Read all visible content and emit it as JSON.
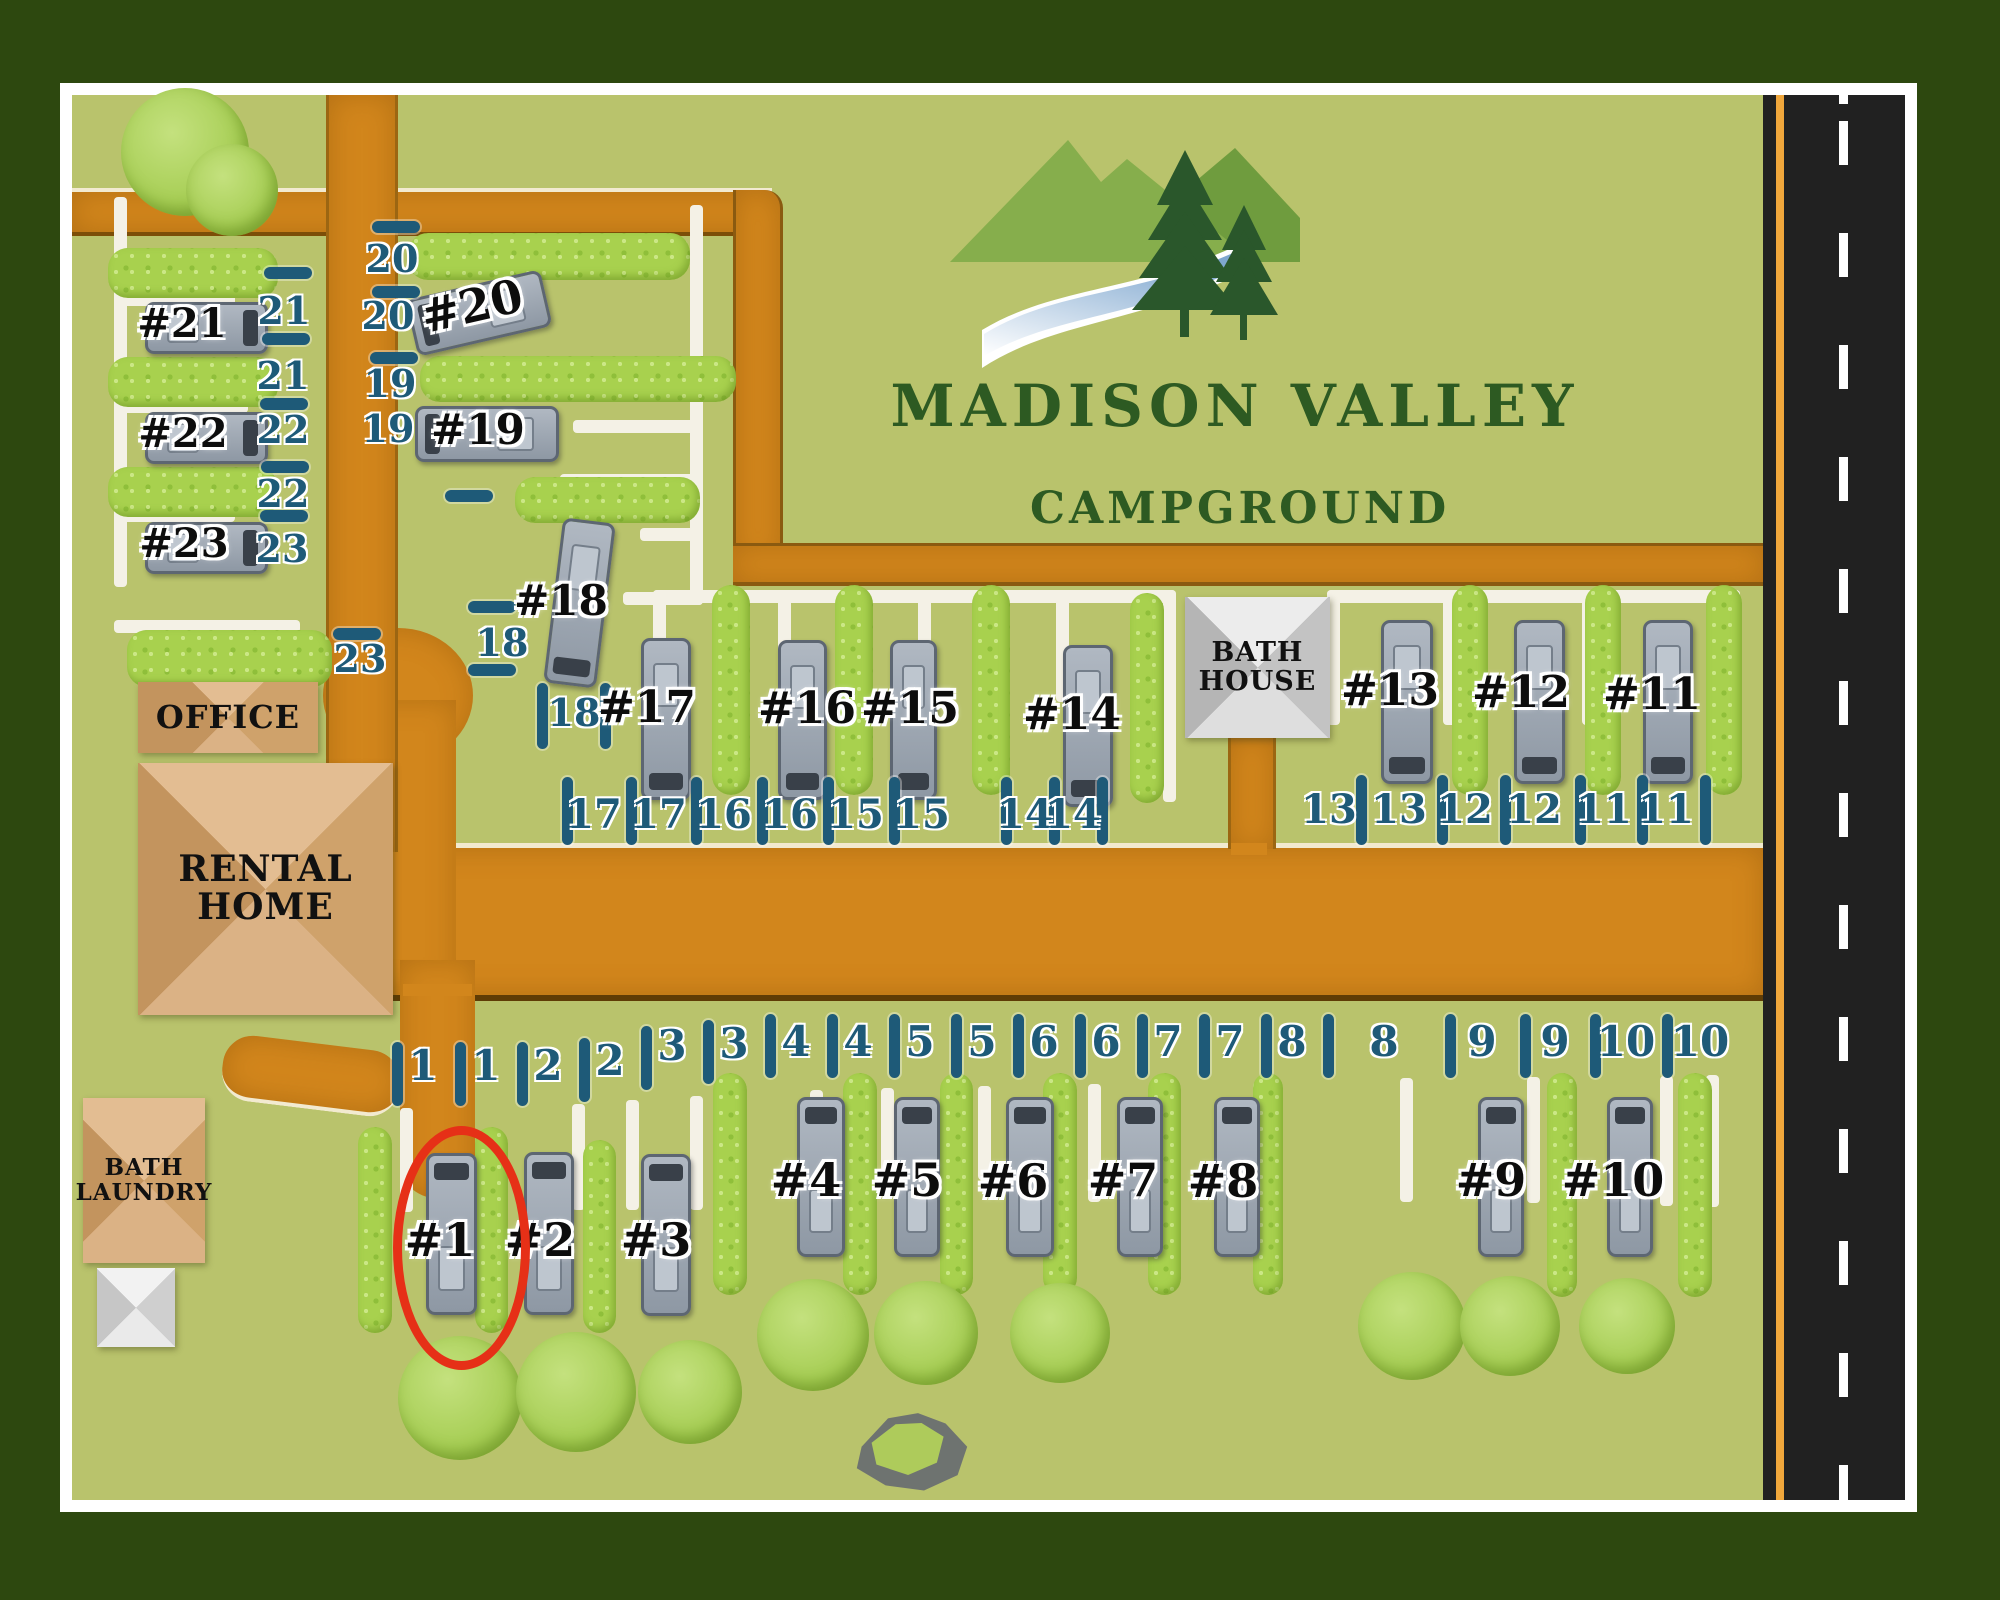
{
  "logo": {
    "title": "MADISON VALLEY",
    "subtitle": "CAMPGROUND"
  },
  "colors": {
    "frame_green": "#2d480f",
    "map_green": "#b9c36c",
    "road_orange": "#d2861c",
    "highway_dark": "#212121",
    "highway_edge_orange": "#f0a73c",
    "tick_teal": "#1e5a78",
    "hedge_green": "#a8d14e",
    "building_tan": "#d8b488",
    "highlight_red": "#e63017"
  },
  "buildings": [
    {
      "id": "office",
      "label": "OFFICE",
      "x": 138,
      "y": 682,
      "w": 180,
      "h": 71,
      "style": "b-tan",
      "font": 32
    },
    {
      "id": "rental-home",
      "label": "RENTAL\nHOME",
      "x": 138,
      "y": 763,
      "w": 255,
      "h": 252,
      "style": "b-tan",
      "font": 36
    },
    {
      "id": "bath-house",
      "label": "BATH\nHOUSE",
      "x": 1185,
      "y": 597,
      "w": 145,
      "h": 141,
      "style": "b-gray",
      "font": 27
    },
    {
      "id": "bath-laundry",
      "label": "BATH\nLAUNDRY",
      "x": 83,
      "y": 1098,
      "w": 122,
      "h": 165,
      "style": "b-tan",
      "font": 23
    },
    {
      "id": "outbuilding",
      "label": "",
      "x": 97,
      "y": 1268,
      "w": 78,
      "h": 79,
      "style": "b-lightgray",
      "font": 0
    }
  ],
  "sites": [
    {
      "num": "#1",
      "rv": {
        "x": 426,
        "y": 1153,
        "w": 45,
        "h": 156,
        "rot": 0,
        "cab": "cab-top"
      },
      "label": {
        "x": 440,
        "y": 1242,
        "size": 46
      }
    },
    {
      "num": "#2",
      "rv": {
        "x": 524,
        "y": 1152,
        "w": 44,
        "h": 157,
        "rot": 0,
        "cab": "cab-top"
      },
      "label": {
        "x": 540,
        "y": 1242,
        "size": 46
      }
    },
    {
      "num": "#3",
      "rv": {
        "x": 641,
        "y": 1154,
        "w": 44,
        "h": 156,
        "rot": 0,
        "cab": "cab-top"
      },
      "label": {
        "x": 656,
        "y": 1242,
        "size": 46
      }
    },
    {
      "num": "#4",
      "rv": {
        "x": 797,
        "y": 1097,
        "w": 42,
        "h": 154,
        "rot": 0,
        "cab": "cab-top"
      },
      "label": {
        "x": 806,
        "y": 1182,
        "size": 46
      }
    },
    {
      "num": "#5",
      "rv": {
        "x": 894,
        "y": 1097,
        "w": 40,
        "h": 154,
        "rot": 0,
        "cab": "cab-top"
      },
      "label": {
        "x": 907,
        "y": 1182,
        "size": 46
      }
    },
    {
      "num": "#6",
      "rv": {
        "x": 1006,
        "y": 1097,
        "w": 42,
        "h": 154,
        "rot": 0,
        "cab": "cab-top"
      },
      "label": {
        "x": 1013,
        "y": 1183,
        "size": 46
      }
    },
    {
      "num": "#7",
      "rv": {
        "x": 1117,
        "y": 1097,
        "w": 40,
        "h": 154,
        "rot": 0,
        "cab": "cab-top"
      },
      "label": {
        "x": 1123,
        "y": 1182,
        "size": 46
      }
    },
    {
      "num": "#8",
      "rv": {
        "x": 1214,
        "y": 1097,
        "w": 40,
        "h": 154,
        "rot": 0,
        "cab": "cab-top"
      },
      "label": {
        "x": 1223,
        "y": 1183,
        "size": 46
      }
    },
    {
      "num": "#9",
      "rv": {
        "x": 1478,
        "y": 1097,
        "w": 40,
        "h": 154,
        "rot": 0,
        "cab": "cab-top"
      },
      "label": {
        "x": 1491,
        "y": 1182,
        "size": 46
      }
    },
    {
      "num": "#10",
      "rv": {
        "x": 1607,
        "y": 1097,
        "w": 40,
        "h": 154,
        "rot": 0,
        "cab": "cab-top"
      },
      "label": {
        "x": 1613,
        "y": 1182,
        "size": 46
      }
    },
    {
      "num": "#11",
      "rv": {
        "x": 1643,
        "y": 620,
        "w": 44,
        "h": 158,
        "rot": 0,
        "cab": "cab-bottom"
      },
      "label": {
        "x": 1652,
        "y": 696,
        "size": 44
      }
    },
    {
      "num": "#12",
      "rv": {
        "x": 1514,
        "y": 620,
        "w": 45,
        "h": 158,
        "rot": 0,
        "cab": "cab-bottom"
      },
      "label": {
        "x": 1521,
        "y": 694,
        "size": 44
      }
    },
    {
      "num": "#13",
      "rv": {
        "x": 1381,
        "y": 620,
        "w": 46,
        "h": 158,
        "rot": 0,
        "cab": "cab-bottom"
      },
      "label": {
        "x": 1390,
        "y": 692,
        "size": 44
      }
    },
    {
      "num": "#14",
      "rv": {
        "x": 1063,
        "y": 645,
        "w": 44,
        "h": 156,
        "rot": 0,
        "cab": "cab-bottom"
      },
      "label": {
        "x": 1072,
        "y": 716,
        "size": 44
      }
    },
    {
      "num": "#15",
      "rv": {
        "x": 890,
        "y": 640,
        "w": 41,
        "h": 154,
        "rot": 0,
        "cab": "cab-bottom"
      },
      "label": {
        "x": 910,
        "y": 710,
        "size": 44
      }
    },
    {
      "num": "#16",
      "rv": {
        "x": 778,
        "y": 640,
        "w": 43,
        "h": 154,
        "rot": 0,
        "cab": "cab-bottom"
      },
      "label": {
        "x": 807,
        "y": 710,
        "size": 44
      }
    },
    {
      "num": "#17",
      "rv": {
        "x": 641,
        "y": 638,
        "w": 44,
        "h": 156,
        "rot": 0,
        "cab": "cab-bottom"
      },
      "label": {
        "x": 647,
        "y": 709,
        "size": 44
      }
    },
    {
      "num": "#18",
      "rv": {
        "x": 553,
        "y": 520,
        "w": 47,
        "h": 160,
        "rot": 7,
        "cab": "cab-bottom"
      },
      "label": {
        "x": 561,
        "y": 602,
        "size": 42
      }
    },
    {
      "num": "#19",
      "rv": {
        "x": 415,
        "y": 406,
        "w": 138,
        "h": 50,
        "rot": 0,
        "cab": "cab-left"
      },
      "label": {
        "x": 478,
        "y": 431,
        "size": 42
      }
    },
    {
      "num": "#20",
      "rv": {
        "x": 410,
        "y": 284,
        "w": 132,
        "h": 52,
        "rot": -13,
        "cab": "cab-left"
      },
      "label": {
        "x": 472,
        "y": 308,
        "size": 46,
        "rot": -13
      }
    },
    {
      "num": "#21",
      "rv": {
        "x": 145,
        "y": 302,
        "w": 117,
        "h": 46,
        "rot": 0,
        "cab": "cab-right"
      },
      "label": {
        "x": 182,
        "y": 325,
        "size": 40
      }
    },
    {
      "num": "#22",
      "rv": {
        "x": 145,
        "y": 412,
        "w": 117,
        "h": 46,
        "rot": 0,
        "cab": "cab-right"
      },
      "label": {
        "x": 183,
        "y": 435,
        "size": 40
      }
    },
    {
      "num": "#23",
      "rv": {
        "x": 145,
        "y": 522,
        "w": 117,
        "h": 46,
        "rot": 0,
        "cab": "cab-right"
      },
      "label": {
        "x": 184,
        "y": 545,
        "size": 40
      }
    }
  ],
  "boundary_numbers": [
    {
      "v": "21",
      "x": 284,
      "y": 313,
      "s": 38
    },
    {
      "v": "21",
      "x": 283,
      "y": 378,
      "s": 38
    },
    {
      "v": "22",
      "x": 283,
      "y": 432,
      "s": 38
    },
    {
      "v": "22",
      "x": 283,
      "y": 496,
      "s": 38
    },
    {
      "v": "23",
      "x": 282,
      "y": 551,
      "s": 38
    },
    {
      "v": "23",
      "x": 360,
      "y": 661,
      "s": 38
    },
    {
      "v": "20",
      "x": 392,
      "y": 261,
      "s": 38
    },
    {
      "v": "20",
      "x": 388,
      "y": 318,
      "s": 38
    },
    {
      "v": "19",
      "x": 390,
      "y": 386,
      "s": 38
    },
    {
      "v": "19",
      "x": 388,
      "y": 431,
      "s": 38
    },
    {
      "v": "18",
      "x": 502,
      "y": 645,
      "s": 38
    },
    {
      "v": "18",
      "x": 574,
      "y": 715,
      "s": 38
    },
    {
      "v": "17",
      "x": 594,
      "y": 817,
      "s": 40
    },
    {
      "v": "17",
      "x": 659,
      "y": 817,
      "s": 40
    },
    {
      "v": "16",
      "x": 724,
      "y": 817,
      "s": 40
    },
    {
      "v": "16",
      "x": 790,
      "y": 817,
      "s": 40
    },
    {
      "v": "15",
      "x": 856,
      "y": 817,
      "s": 40
    },
    {
      "v": "15",
      "x": 922,
      "y": 817,
      "s": 40
    },
    {
      "v": "14",
      "x": 1025,
      "y": 817,
      "s": 40
    },
    {
      "v": "14",
      "x": 1073,
      "y": 817,
      "s": 40
    },
    {
      "v": "13",
      "x": 1329,
      "y": 812,
      "s": 40
    },
    {
      "v": "13",
      "x": 1399,
      "y": 812,
      "s": 40
    },
    {
      "v": "12",
      "x": 1465,
      "y": 812,
      "s": 40
    },
    {
      "v": "12",
      "x": 1534,
      "y": 812,
      "s": 40
    },
    {
      "v": "11",
      "x": 1604,
      "y": 812,
      "s": 40
    },
    {
      "v": "11",
      "x": 1666,
      "y": 812,
      "s": 40
    },
    {
      "v": "1",
      "x": 423,
      "y": 1068,
      "s": 42
    },
    {
      "v": "1",
      "x": 486,
      "y": 1068,
      "s": 42
    },
    {
      "v": "2",
      "x": 548,
      "y": 1068,
      "s": 42
    },
    {
      "v": "2",
      "x": 610,
      "y": 1063,
      "s": 42
    },
    {
      "v": "3",
      "x": 672,
      "y": 1048,
      "s": 42
    },
    {
      "v": "3",
      "x": 734,
      "y": 1046,
      "s": 42
    },
    {
      "v": "4",
      "x": 796,
      "y": 1044,
      "s": 42
    },
    {
      "v": "4",
      "x": 858,
      "y": 1044,
      "s": 42
    },
    {
      "v": "5",
      "x": 920,
      "y": 1044,
      "s": 42
    },
    {
      "v": "5",
      "x": 982,
      "y": 1044,
      "s": 42
    },
    {
      "v": "6",
      "x": 1044,
      "y": 1044,
      "s": 42
    },
    {
      "v": "6",
      "x": 1106,
      "y": 1044,
      "s": 42
    },
    {
      "v": "7",
      "x": 1168,
      "y": 1044,
      "s": 42
    },
    {
      "v": "7",
      "x": 1230,
      "y": 1044,
      "s": 42
    },
    {
      "v": "8",
      "x": 1292,
      "y": 1044,
      "s": 42
    },
    {
      "v": "8",
      "x": 1384,
      "y": 1044,
      "s": 42
    },
    {
      "v": "9",
      "x": 1482,
      "y": 1044,
      "s": 42
    },
    {
      "v": "9",
      "x": 1555,
      "y": 1044,
      "s": 42
    },
    {
      "v": "10",
      "x": 1626,
      "y": 1044,
      "s": 42
    },
    {
      "v": "10",
      "x": 1700,
      "y": 1044,
      "s": 42
    }
  ],
  "tick_dashes": [
    {
      "x": 264,
      "y": 267
    },
    {
      "x": 262,
      "y": 333
    },
    {
      "x": 260,
      "y": 398
    },
    {
      "x": 261,
      "y": 461
    },
    {
      "x": 260,
      "y": 510
    },
    {
      "x": 333,
      "y": 628
    },
    {
      "x": 372,
      "y": 221
    },
    {
      "x": 372,
      "y": 286
    },
    {
      "x": 370,
      "y": 352
    },
    {
      "x": 445,
      "y": 490
    },
    {
      "x": 468,
      "y": 601
    },
    {
      "x": 468,
      "y": 664
    }
  ],
  "tick_bars": [
    {
      "x": 537,
      "y": 683,
      "h": 66
    },
    {
      "x": 600,
      "y": 683,
      "h": 66
    },
    {
      "x": 562,
      "y": 777,
      "h": 68
    },
    {
      "x": 626,
      "y": 777,
      "h": 68
    },
    {
      "x": 691,
      "y": 777,
      "h": 68
    },
    {
      "x": 757,
      "y": 777,
      "h": 68
    },
    {
      "x": 823,
      "y": 777,
      "h": 68
    },
    {
      "x": 889,
      "y": 777,
      "h": 68
    },
    {
      "x": 1001,
      "y": 777,
      "h": 68
    },
    {
      "x": 1049,
      "y": 777,
      "h": 68
    },
    {
      "x": 1097,
      "y": 777,
      "h": 68
    },
    {
      "x": 1356,
      "y": 775,
      "h": 70
    },
    {
      "x": 1437,
      "y": 775,
      "h": 70
    },
    {
      "x": 1500,
      "y": 775,
      "h": 70
    },
    {
      "x": 1575,
      "y": 775,
      "h": 70
    },
    {
      "x": 1637,
      "y": 775,
      "h": 70
    },
    {
      "x": 1700,
      "y": 775,
      "h": 70
    },
    {
      "x": 392,
      "y": 1042,
      "h": 64
    },
    {
      "x": 455,
      "y": 1042,
      "h": 64
    },
    {
      "x": 517,
      "y": 1042,
      "h": 64
    },
    {
      "x": 579,
      "y": 1038,
      "h": 64
    },
    {
      "x": 641,
      "y": 1026,
      "h": 64
    },
    {
      "x": 703,
      "y": 1020,
      "h": 64
    },
    {
      "x": 765,
      "y": 1014,
      "h": 64
    },
    {
      "x": 827,
      "y": 1014,
      "h": 64
    },
    {
      "x": 889,
      "y": 1014,
      "h": 64
    },
    {
      "x": 951,
      "y": 1014,
      "h": 64
    },
    {
      "x": 1013,
      "y": 1014,
      "h": 64
    },
    {
      "x": 1075,
      "y": 1014,
      "h": 64
    },
    {
      "x": 1137,
      "y": 1014,
      "h": 64
    },
    {
      "x": 1199,
      "y": 1014,
      "h": 64
    },
    {
      "x": 1261,
      "y": 1014,
      "h": 64
    },
    {
      "x": 1323,
      "y": 1014,
      "h": 64
    },
    {
      "x": 1445,
      "y": 1014,
      "h": 64
    },
    {
      "x": 1520,
      "y": 1014,
      "h": 64
    },
    {
      "x": 1590,
      "y": 1014,
      "h": 64
    },
    {
      "x": 1662,
      "y": 1014,
      "h": 64
    }
  ],
  "hedges": [
    {
      "x": 108,
      "y": 248,
      "w": 170,
      "h": 50
    },
    {
      "x": 108,
      "y": 357,
      "w": 170,
      "h": 50
    },
    {
      "x": 108,
      "y": 467,
      "w": 170,
      "h": 50
    },
    {
      "x": 127,
      "y": 630,
      "w": 205,
      "h": 57
    },
    {
      "x": 408,
      "y": 233,
      "w": 282,
      "h": 47
    },
    {
      "x": 420,
      "y": 356,
      "w": 316,
      "h": 46
    },
    {
      "x": 515,
      "y": 477,
      "w": 185,
      "h": 46
    },
    {
      "x": 712,
      "y": 585,
      "w": 38,
      "h": 210
    },
    {
      "x": 835,
      "y": 585,
      "w": 38,
      "h": 210
    },
    {
      "x": 972,
      "y": 585,
      "w": 38,
      "h": 210
    },
    {
      "x": 1130,
      "y": 593,
      "w": 34,
      "h": 210
    },
    {
      "x": 1452,
      "y": 585,
      "w": 36,
      "h": 210
    },
    {
      "x": 1585,
      "y": 585,
      "w": 36,
      "h": 210
    },
    {
      "x": 1706,
      "y": 585,
      "w": 36,
      "h": 210
    },
    {
      "x": 358,
      "y": 1127,
      "w": 34,
      "h": 206
    },
    {
      "x": 475,
      "y": 1127,
      "w": 33,
      "h": 206
    },
    {
      "x": 583,
      "y": 1140,
      "w": 33,
      "h": 193
    },
    {
      "x": 713,
      "y": 1073,
      "w": 34,
      "h": 222
    },
    {
      "x": 843,
      "y": 1073,
      "w": 34,
      "h": 222
    },
    {
      "x": 940,
      "y": 1073,
      "w": 33,
      "h": 222
    },
    {
      "x": 1043,
      "y": 1073,
      "w": 34,
      "h": 222
    },
    {
      "x": 1148,
      "y": 1073,
      "w": 33,
      "h": 222
    },
    {
      "x": 1253,
      "y": 1073,
      "w": 30,
      "h": 222
    },
    {
      "x": 1547,
      "y": 1073,
      "w": 30,
      "h": 224
    },
    {
      "x": 1678,
      "y": 1073,
      "w": 34,
      "h": 224
    }
  ],
  "trees": [
    {
      "cx": 185,
      "cy": 152,
      "r": 64
    },
    {
      "cx": 232,
      "cy": 190,
      "r": 46
    },
    {
      "cx": 460,
      "cy": 1398,
      "r": 62
    },
    {
      "cx": 576,
      "cy": 1392,
      "r": 60
    },
    {
      "cx": 690,
      "cy": 1392,
      "r": 52
    },
    {
      "cx": 813,
      "cy": 1335,
      "r": 56
    },
    {
      "cx": 926,
      "cy": 1333,
      "r": 52
    },
    {
      "cx": 1060,
      "cy": 1333,
      "r": 50
    },
    {
      "cx": 1412,
      "cy": 1326,
      "r": 54
    },
    {
      "cx": 1510,
      "cy": 1326,
      "r": 50
    },
    {
      "cx": 1627,
      "cy": 1326,
      "r": 48
    }
  ],
  "driveways": [
    {
      "x": 114,
      "y": 197,
      "w": 13,
      "h": 390
    },
    {
      "x": 114,
      "y": 293,
      "w": 121,
      "h": 13
    },
    {
      "x": 114,
      "y": 400,
      "w": 134,
      "h": 13
    },
    {
      "x": 114,
      "y": 509,
      "w": 121,
      "h": 13
    },
    {
      "x": 114,
      "y": 620,
      "w": 186,
      "h": 13
    },
    {
      "x": 690,
      "y": 205,
      "w": 13,
      "h": 400
    },
    {
      "x": 597,
      "y": 363,
      "w": 106,
      "h": 13
    },
    {
      "x": 573,
      "y": 420,
      "w": 130,
      "h": 13
    },
    {
      "x": 560,
      "y": 474,
      "w": 142,
      "h": 13
    },
    {
      "x": 640,
      "y": 528,
      "w": 63,
      "h": 13
    },
    {
      "x": 623,
      "y": 592,
      "w": 80,
      "h": 13
    },
    {
      "x": 653,
      "y": 590,
      "w": 523,
      "h": 13
    },
    {
      "x": 653,
      "y": 590,
      "w": 13,
      "h": 112
    },
    {
      "x": 778,
      "y": 590,
      "w": 13,
      "h": 112
    },
    {
      "x": 918,
      "y": 590,
      "w": 13,
      "h": 112
    },
    {
      "x": 1056,
      "y": 590,
      "w": 13,
      "h": 112
    },
    {
      "x": 1163,
      "y": 590,
      "w": 13,
      "h": 212
    },
    {
      "x": 1327,
      "y": 590,
      "w": 413,
      "h": 13
    },
    {
      "x": 1327,
      "y": 590,
      "w": 13,
      "h": 135
    },
    {
      "x": 1443,
      "y": 590,
      "w": 13,
      "h": 135
    },
    {
      "x": 1582,
      "y": 590,
      "w": 13,
      "h": 135
    },
    {
      "x": 1727,
      "y": 590,
      "w": 13,
      "h": 143
    },
    {
      "x": 400,
      "y": 1108,
      "w": 13,
      "h": 104
    },
    {
      "x": 468,
      "y": 1156,
      "w": 13,
      "h": 84
    },
    {
      "x": 572,
      "y": 1104,
      "w": 13,
      "h": 106
    },
    {
      "x": 626,
      "y": 1100,
      "w": 13,
      "h": 110
    },
    {
      "x": 690,
      "y": 1096,
      "w": 13,
      "h": 114
    },
    {
      "x": 810,
      "y": 1090,
      "w": 13,
      "h": 100
    },
    {
      "x": 881,
      "y": 1088,
      "w": 13,
      "h": 88
    },
    {
      "x": 978,
      "y": 1086,
      "w": 13,
      "h": 94
    },
    {
      "x": 1088,
      "y": 1084,
      "w": 13,
      "h": 118
    },
    {
      "x": 1157,
      "y": 1083,
      "w": 13,
      "h": 120
    },
    {
      "x": 1253,
      "y": 1082,
      "w": 13,
      "h": 126
    },
    {
      "x": 1400,
      "y": 1078,
      "w": 13,
      "h": 124
    },
    {
      "x": 1527,
      "y": 1077,
      "w": 13,
      "h": 126
    },
    {
      "x": 1660,
      "y": 1076,
      "w": 13,
      "h": 130
    },
    {
      "x": 1706,
      "y": 1075,
      "w": 13,
      "h": 132
    }
  ],
  "highlight": {
    "site": "#1",
    "x": 393,
    "y": 1126,
    "w": 119,
    "h": 226
  }
}
